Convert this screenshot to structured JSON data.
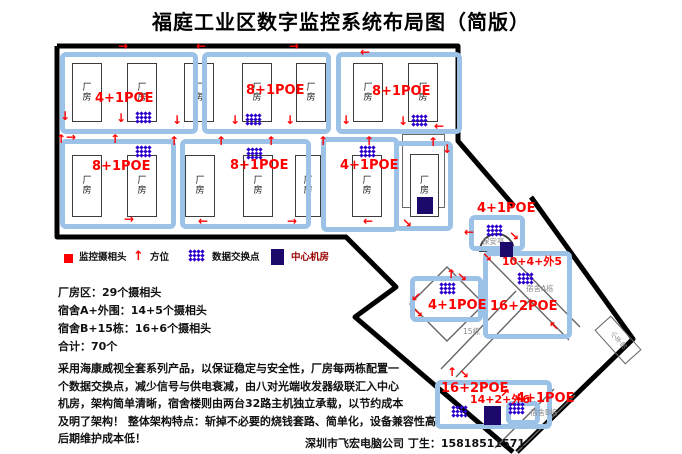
{
  "title": "福庭工业区数字监控系统布局图（简版）",
  "factory": {
    "building_label": "厂房",
    "groups": [
      {
        "label": "4+1POE"
      },
      {
        "label": "8+1POE"
      },
      {
        "label": "8+1POE"
      },
      {
        "label": "8+1POE"
      },
      {
        "label": "8+1POE"
      },
      {
        "label": "4+1POE"
      }
    ]
  },
  "dorm": {
    "booth": {
      "poe": "4+1POE",
      "name": "保安亭"
    },
    "dorm_a": {
      "count": "10+4+外5",
      "poe": "16+2POE",
      "name": "宿舍A栋"
    },
    "left_group": {
      "poe": "4+1POE"
    },
    "bottom_group": {
      "poe": "16+2POE",
      "count": "14+2+外6"
    },
    "dorm_b": {
      "poe": "4+1POE",
      "name": "宿舍B栋"
    },
    "building15_label": "15栋",
    "small_house_label": "小平房"
  },
  "legend": {
    "items": [
      {
        "icon": "camera-square",
        "label": "监控摄相头"
      },
      {
        "icon": "direction-arrow",
        "glyph": "↑",
        "label": "方位"
      },
      {
        "icon": "switch-dots",
        "label": "数据交换点"
      },
      {
        "icon": "server-square",
        "label": "中心机房"
      }
    ]
  },
  "summary": [
    "厂房区：29个摄相头",
    "宿舍A+外围：14+5个摄相头",
    "宿舍B+15栋：16+6个摄相头",
    "合计：70个"
  ],
  "description": "采用海康威视全套系列产品，以保证稳定与安全性，厂房每两栋配置一\n个数据交换点，减少信号与供电衰减，由八对光端收发器级联汇入中心\n机房，架构简单清晰，宿舍楼则由两台32路主机独立承载，以节约成本\n及明了架构！ 整体架构特点：斩掉不必要的烧钱套路、简单化，设备兼容性高\n后期维护成本低！",
  "signature": "深圳市飞宏电脑公司 丁生：15818511571",
  "colors": {
    "group_border": "#9cc2e8",
    "poe_red": "#ff0000",
    "switch_blue": "#2d00cc",
    "server_navy": "#1c096b",
    "legend_server_text": "#990000",
    "boundary_black": "#000000"
  },
  "markers": {
    "buildings": [
      [
        72,
        63,
        30,
        59
      ],
      [
        127,
        63,
        30,
        59
      ],
      [
        184,
        63,
        30,
        59
      ],
      [
        242,
        63,
        30,
        59
      ],
      [
        296,
        63,
        30,
        59
      ],
      [
        353,
        63,
        30,
        59
      ],
      [
        408,
        63,
        30,
        59
      ],
      [
        72,
        155,
        30,
        62
      ],
      [
        127,
        155,
        30,
        62
      ],
      [
        185,
        155,
        30,
        62
      ],
      [
        243,
        155,
        30,
        62
      ],
      [
        295,
        155,
        26,
        62
      ],
      [
        352,
        155,
        30,
        62
      ],
      [
        410,
        154,
        29,
        63
      ]
    ],
    "switch_clusters": [
      [
        136,
        112
      ],
      [
        246,
        114
      ],
      [
        412,
        115
      ],
      [
        136,
        146
      ],
      [
        247,
        148
      ],
      [
        360,
        146
      ],
      [
        487,
        225
      ],
      [
        518,
        273
      ],
      [
        440,
        283
      ],
      [
        452,
        406
      ],
      [
        509,
        403
      ],
      [
        189,
        250
      ]
    ],
    "server_squares": [
      [
        417,
        197,
        16,
        17
      ],
      [
        500,
        242,
        13,
        15
      ],
      [
        484,
        406,
        17,
        19
      ],
      [
        271,
        249,
        13,
        16
      ]
    ],
    "arrows": [
      {
        "g": "→",
        "x": 118,
        "y": 40
      },
      {
        "g": "←",
        "x": 196,
        "y": 40
      },
      {
        "g": "→",
        "x": 289,
        "y": 40
      },
      {
        "g": "←",
        "x": 360,
        "y": 46
      },
      {
        "g": "↓",
        "x": 60,
        "y": 110
      },
      {
        "g": "↓",
        "x": 116,
        "y": 112
      },
      {
        "g": "↓",
        "x": 172,
        "y": 114
      },
      {
        "g": "↓",
        "x": 230,
        "y": 114
      },
      {
        "g": "↓",
        "x": 285,
        "y": 114
      },
      {
        "g": "↓",
        "x": 341,
        "y": 114
      },
      {
        "g": "↓",
        "x": 398,
        "y": 115
      },
      {
        "g": "←",
        "x": 434,
        "y": 120
      },
      {
        "g": "↑",
        "x": 56,
        "y": 133
      },
      {
        "g": "→",
        "x": 66,
        "y": 131
      },
      {
        "g": "↑",
        "x": 110,
        "y": 133
      },
      {
        "g": "↑",
        "x": 169,
        "y": 135
      },
      {
        "g": "↑",
        "x": 216,
        "y": 135
      },
      {
        "g": "↑",
        "x": 266,
        "y": 135
      },
      {
        "g": "↑",
        "x": 318,
        "y": 135
      },
      {
        "g": "↑",
        "x": 364,
        "y": 135
      },
      {
        "g": "↑",
        "x": 428,
        "y": 136
      },
      {
        "g": "↓",
        "x": 442,
        "y": 143
      },
      {
        "g": "→",
        "x": 124,
        "y": 213
      },
      {
        "g": "←",
        "x": 198,
        "y": 215
      },
      {
        "g": "→",
        "x": 287,
        "y": 215
      },
      {
        "g": "←",
        "x": 363,
        "y": 215
      },
      {
        "g": "↘",
        "x": 402,
        "y": 217
      },
      {
        "g": "←",
        "x": 464,
        "y": 226
      },
      {
        "g": "↘",
        "x": 509,
        "y": 230
      },
      {
        "g": "↘",
        "x": 482,
        "y": 251
      },
      {
        "g": "↖",
        "x": 549,
        "y": 320
      },
      {
        "g": "↑",
        "x": 446,
        "y": 268
      },
      {
        "g": "↘",
        "x": 457,
        "y": 271
      },
      {
        "g": "↙",
        "x": 411,
        "y": 291
      },
      {
        "g": "↘",
        "x": 413,
        "y": 307
      },
      {
        "g": "↑",
        "x": 447,
        "y": 366
      },
      {
        "g": "↘",
        "x": 459,
        "y": 368
      },
      {
        "g": "↗",
        "x": 500,
        "y": 387
      }
    ]
  }
}
